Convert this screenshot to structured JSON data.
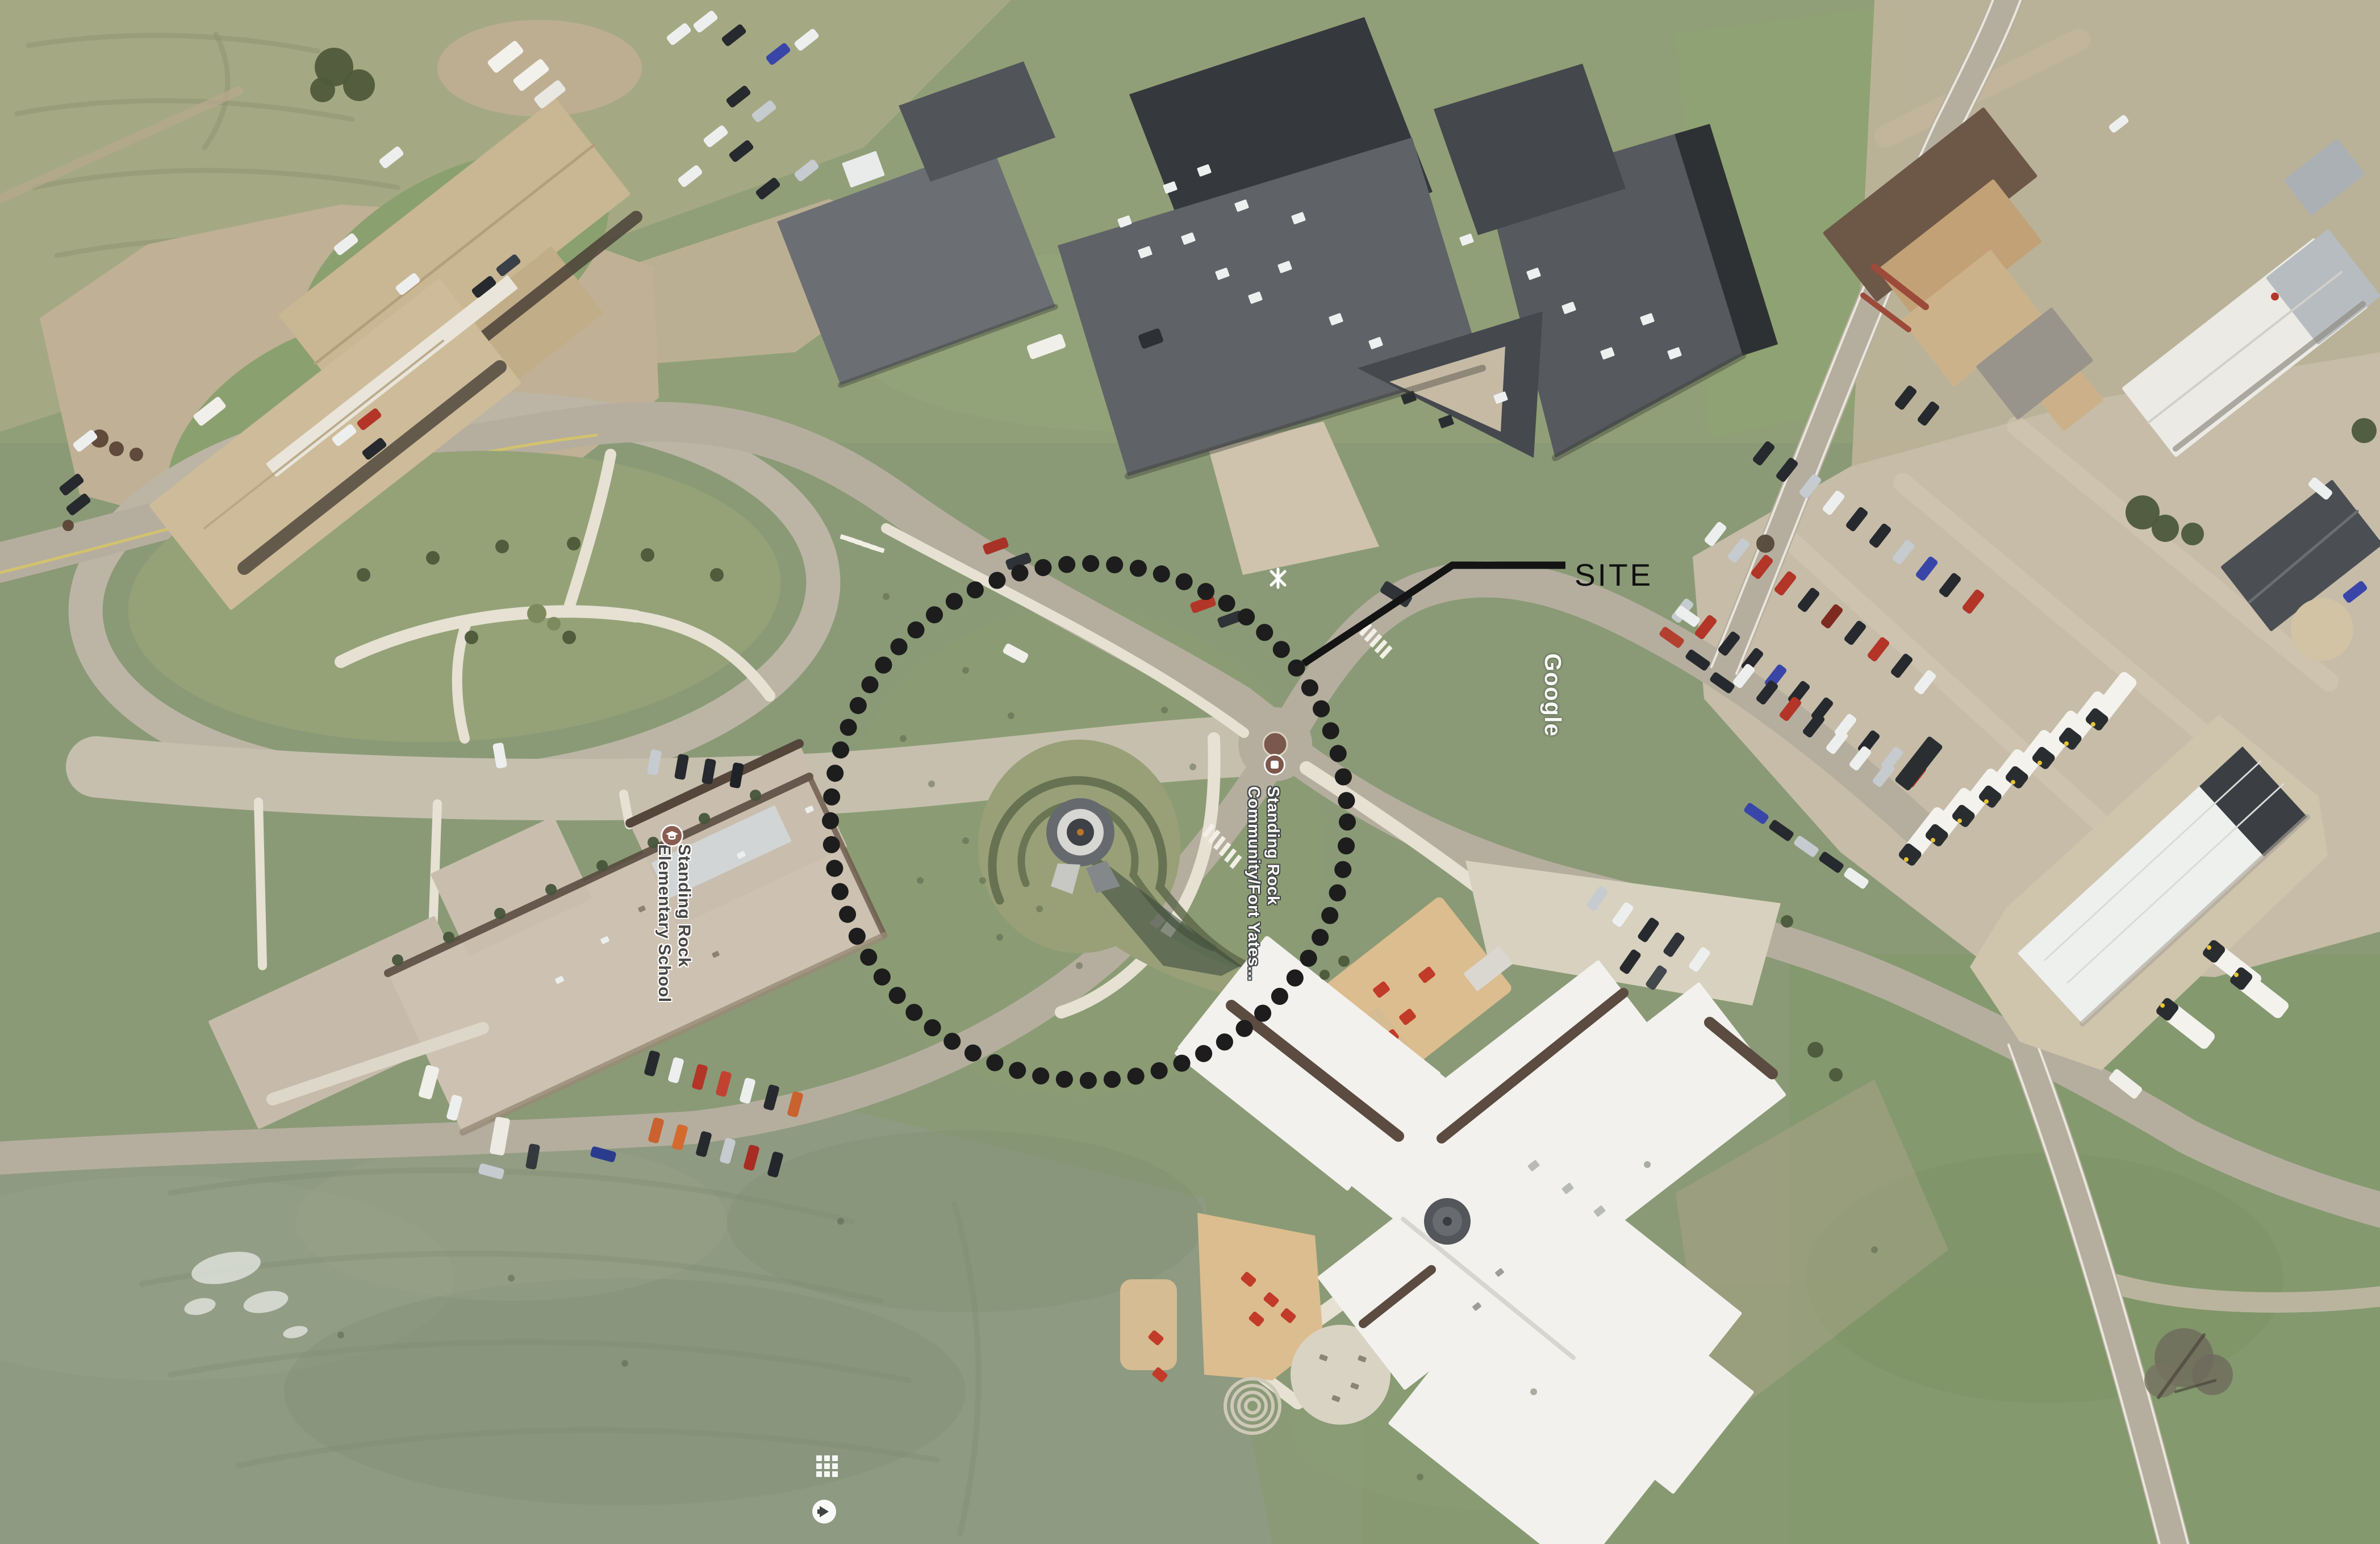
{
  "annotation": {
    "site_label": "SITE",
    "circle_color": "#1d1d1d",
    "leader_color": "#141414"
  },
  "map_labels": {
    "school": {
      "line1": "Standing Rock",
      "line2": "Elementary School"
    },
    "community": {
      "line1": "Standing Rock",
      "line2": "Community/Fort Yates..."
    },
    "watermark": "Google"
  },
  "ui_icons": {
    "school_poi": "school-poi-icon",
    "community_poi": "community-poi-icon",
    "tile_grid": "tile-grid-icon",
    "pegman_circle": "pegman-circle-icon"
  },
  "colors": {
    "grass": "#8a9a76",
    "dirt": "#c1b299",
    "road": "#b5ae9f",
    "sidewalk": "#e6e1d3",
    "dark_roof": "#5f6267",
    "tan_roof": "#cdc2b1",
    "white_roof": "#f2f1ed",
    "poi_icon": "#7d564c",
    "label_dark_text": "#474645",
    "label_light_text": "#fbfaf6"
  }
}
